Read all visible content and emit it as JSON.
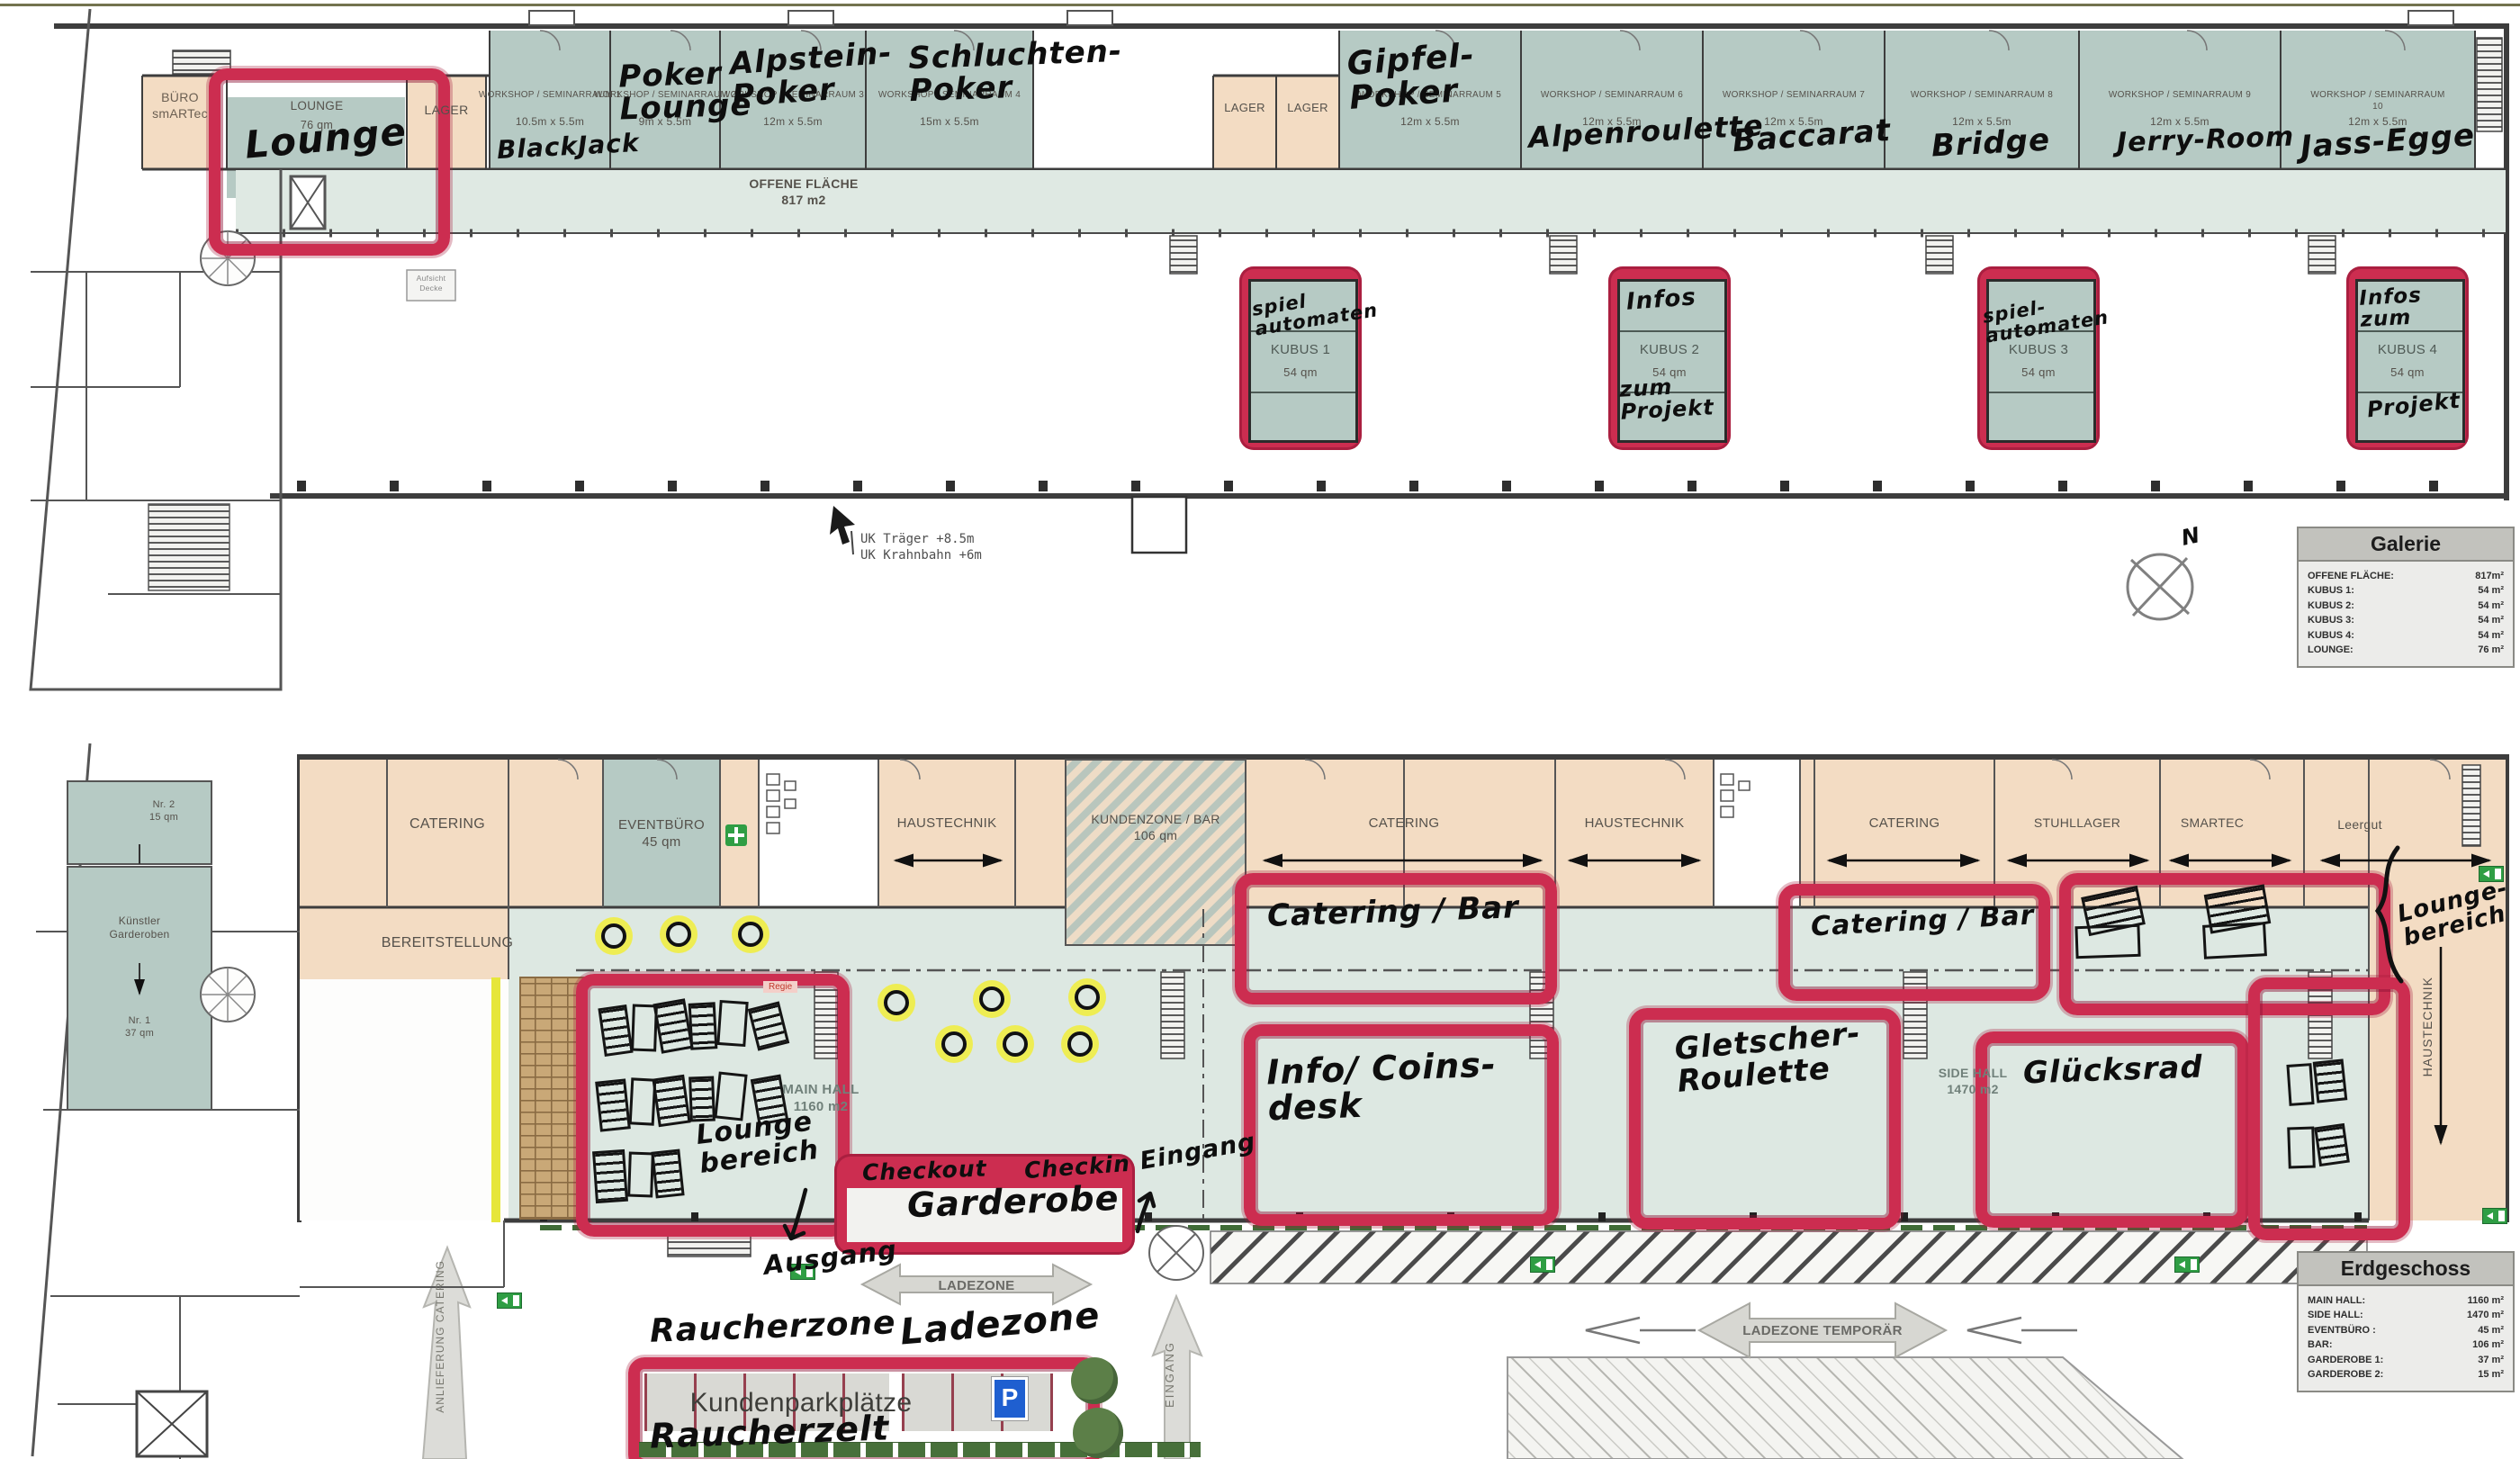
{
  "galerie": {
    "compass_n": "N",
    "buero": "BÜRO\nsmARTec",
    "lounge": {
      "name": "LOUNGE",
      "size": "76 qm",
      "hand": "Lounge"
    },
    "lager_a": "LAGER",
    "lager_b": "LAGER",
    "lager_c": "LAGER",
    "offene": "OFFENE FLÄCHE\n817 m2",
    "aufsicht": "Aufsicht\nDecke",
    "uk_note": "UK Träger +8.5m\nUK Krahnbahn +6m",
    "workshops": [
      {
        "name": "WORKSHOP / SEMINARRAUM 1",
        "size": "10.5m x 5.5m",
        "hand": "BlackJack"
      },
      {
        "name": "WORKSHOP / SEMINARRAUM 2",
        "size": "9m x 5.5m",
        "hand": "Poker\nLounge"
      },
      {
        "name": "WORKSHOP / SEMINARRAUM 3",
        "size": "12m x 5.5m",
        "hand": "Alpstein-\nPoker"
      },
      {
        "name": "WORKSHOP / SEMINARRAUM 4",
        "size": "15m x 5.5m",
        "hand": "Schluchten-\nPoker"
      },
      {
        "name": "WORKSHOP / SEMINARRAUM 5",
        "size": "12m x 5.5m",
        "hand": "Gipfel-\nPoker"
      },
      {
        "name": "WORKSHOP / SEMINARRAUM 6",
        "size": "12m x 5.5m",
        "hand": "Alpenroulette"
      },
      {
        "name": "WORKSHOP / SEMINARRAUM 7",
        "size": "12m x 5.5m",
        "hand": "Baccarat"
      },
      {
        "name": "WORKSHOP / SEMINARRAUM 8",
        "size": "12m x 5.5m",
        "hand": "Bridge"
      },
      {
        "name": "WORKSHOP / SEMINARRAUM 9",
        "size": "12m x 5.5m",
        "hand": "Jerry-Room"
      },
      {
        "name": "WORKSHOP / SEMINARRAUM 10",
        "size": "12m x 5.5m",
        "hand": "Jass-Egge"
      }
    ],
    "kubus": [
      {
        "name": "KUBUS 1",
        "size": "54 qm",
        "hand_top": "spiel\nautomaten",
        "hand_bottom": ""
      },
      {
        "name": "KUBUS 2",
        "size": "54 qm",
        "hand_top": "Infos",
        "hand_bottom": "zum\nProjekt"
      },
      {
        "name": "KUBUS 3",
        "size": "54 qm",
        "hand_top": "spiel-\nautomaten",
        "hand_bottom": ""
      },
      {
        "name": "KUBUS 4",
        "size": "54 qm",
        "hand_top": "Infos\nzum",
        "hand_bottom": "Projekt"
      }
    ],
    "legend": {
      "title": "Galerie",
      "rows": [
        [
          "OFFENE FLÄCHE:",
          "817m²"
        ],
        [
          "KUBUS 1:",
          "54 m²"
        ],
        [
          "KUBUS 2:",
          "54 m²"
        ],
        [
          "KUBUS 3:",
          "54 m²"
        ],
        [
          "KUBUS 4:",
          "54 m²"
        ],
        [
          "LOUNGE:",
          "76 m²"
        ]
      ]
    }
  },
  "erdgeschoss": {
    "nr2": "Nr. 2\n15 qm",
    "kuenstler": "Künstler\nGarderoben",
    "nr1": "Nr. 1\n37 qm",
    "catering1": "CATERING",
    "bereitstellung": "BEREITSTELLUNG",
    "eventbuero": "EVENTBÜRO\n45 qm",
    "haustechnik1": "HAUSTECHNIK",
    "kundenzone": "KUNDENZONE / BAR\n106 qm",
    "catering2": "CATERING",
    "haustechnik2": "HAUSTECHNIK",
    "catering3": "CATERING",
    "stuhllager": "STUHLLAGER",
    "smartec": "SMARTEC",
    "leergut": "Leergut",
    "haustechnik_vert": "HAUSTECHNIK",
    "main_hall": "MAIN HALL\n1160 m2",
    "side_hall": "SIDE HALL\n1470 m2",
    "regie": "Regie",
    "ladezone_arrow": "LADEZONE",
    "ladezone_temp": "LADEZONE TEMPORÄR",
    "kundenparkplaetze": "Kundenparkplätze",
    "p_sign": "P",
    "eingang_vert": "EINGANG",
    "anlieferung_vert": "ANLIEFERUNG CATERING",
    "hand": {
      "catering_bar_1": "Catering / Bar",
      "catering_bar_2": "Catering / Bar",
      "info_coins": "Info/ Coins-\ndesk",
      "gletscher": "Gletscher-\nRoulette",
      "gluecksrad": "Glücksrad",
      "lounge_bereich": "Lounge\nbereich",
      "lounge_bereich_right": "Lounge-\nbereich",
      "checkout": "Checkout",
      "checkin": "Checkin",
      "garderobe": "Garderobe",
      "eingang": "Eingang",
      "ausgang": "Ausgang",
      "raucherzone": "Raucherzone",
      "ladezone": "Ladezone",
      "raucherzelt": "Raucherzelt"
    },
    "legend": {
      "title": "Erdgeschoss",
      "rows": [
        [
          "MAIN HALL:",
          "1160 m²"
        ],
        [
          "SIDE HALL:",
          "1470 m²"
        ],
        [
          "EVENTBÜRO :",
          "45 m²"
        ],
        [
          "BAR:",
          "106 m²"
        ],
        [
          "GARDEROBE 1:",
          "37 m²"
        ],
        [
          "GARDEROBE 2:",
          "15 m²"
        ]
      ]
    }
  },
  "colors": {
    "marker": "#cc2d50",
    "room_green": "#b6cac4",
    "room_tan": "#f3dcc3",
    "hall": "#dde8e2"
  }
}
